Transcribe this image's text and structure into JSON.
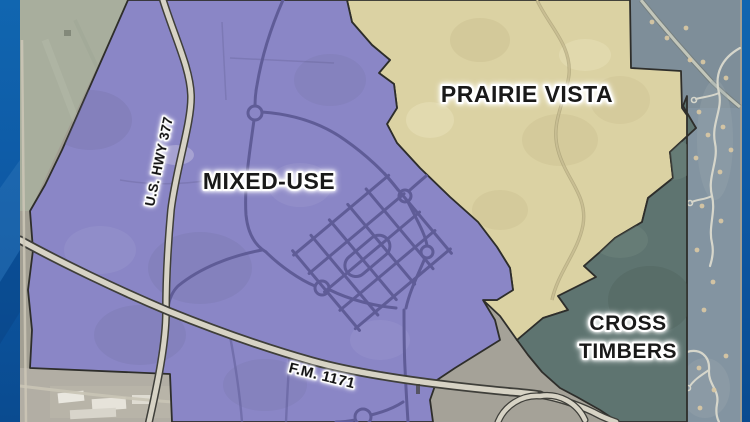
{
  "map": {
    "regions": [
      {
        "id": "mixed-use",
        "label": "MIXED-USE",
        "fill": "#8a86c6"
      },
      {
        "id": "prairie-vista",
        "label": "PRAIRIE VISTA",
        "fill": "#dbd2a3"
      },
      {
        "id": "cross-timbers",
        "label": "CROSS TIMBERS",
        "label_lines": [
          "CROSS",
          "TIMBERS"
        ],
        "fill": "#5e7470"
      }
    ],
    "roads": [
      {
        "id": "us-hwy-377",
        "label": "U.S. HWY 377"
      },
      {
        "id": "fm-1171",
        "label": "F.M. 1171"
      }
    ],
    "border_color": "#2e2e2b"
  },
  "frame": {
    "side_bar_color": "#0d58a2",
    "side_bar_highlight": "#2a74b5"
  }
}
